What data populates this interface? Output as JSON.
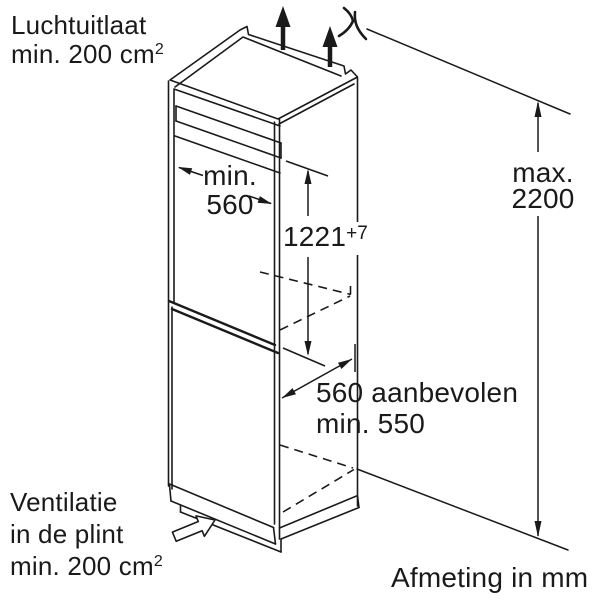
{
  "labels": {
    "air_outlet": {
      "line1": "Luchtuitlaat",
      "line2": "min. 200 cm",
      "sup": "2"
    },
    "niche_width": {
      "line1": "min.",
      "line2": "560"
    },
    "niche_height": {
      "value": "1221",
      "tolerance": "+7"
    },
    "max_height": {
      "line1": "max.",
      "line2": "2200"
    },
    "depth": {
      "line1": "560 aanbevolen",
      "line2": "min. 550"
    },
    "plinth_vent": {
      "line1": "Ventilatie",
      "line2": "in de plint",
      "line3": "min. 200 cm",
      "sup": "2"
    },
    "units_note": "Afmeting in mm"
  },
  "icons": {
    "airflow_up": "solid up arrow",
    "airflow_out_top": "curved sprout arrow",
    "plinth_airflow": "hollow block arrow up-right"
  },
  "colors": {
    "line": "#1a1a1a",
    "background": "#ffffff"
  }
}
